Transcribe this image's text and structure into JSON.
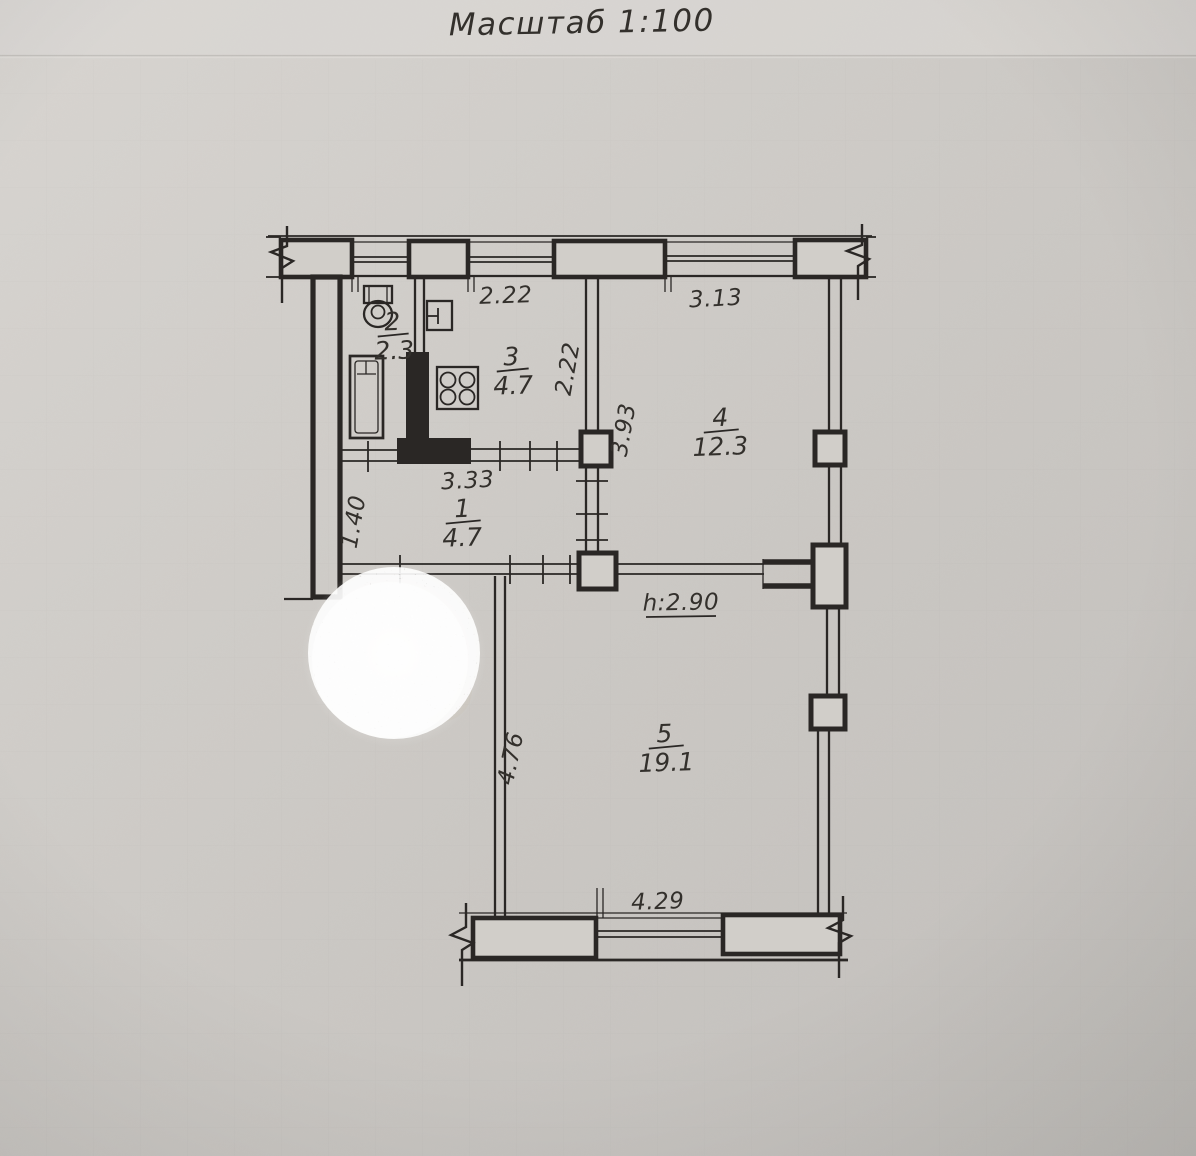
{
  "title": {
    "text": "Масштаб 1:100"
  },
  "colors": {
    "paper": "#cdc9c5",
    "paper2": "#d1cec9",
    "ink": "#2a2725",
    "label_ink": "#33302c"
  },
  "rooms": {
    "room1": {
      "number": "1",
      "area": "4.7"
    },
    "room2": {
      "number": "2",
      "area": "2.3"
    },
    "room3": {
      "number": "3",
      "area": "4.7"
    },
    "room4": {
      "number": "4",
      "area": "12.3"
    },
    "room5": {
      "number": "5",
      "area": "19.1"
    }
  },
  "dims": {
    "top_kitchen": "2.22",
    "top_room4": "3.13",
    "kitchen_depth": "2.22",
    "room4_depth": "3.93",
    "hall_width": "3.33",
    "hall_height": "1.40",
    "room5_depth": "4.76",
    "room5_width": "4.29",
    "ceiling_height": "h:2.90"
  }
}
